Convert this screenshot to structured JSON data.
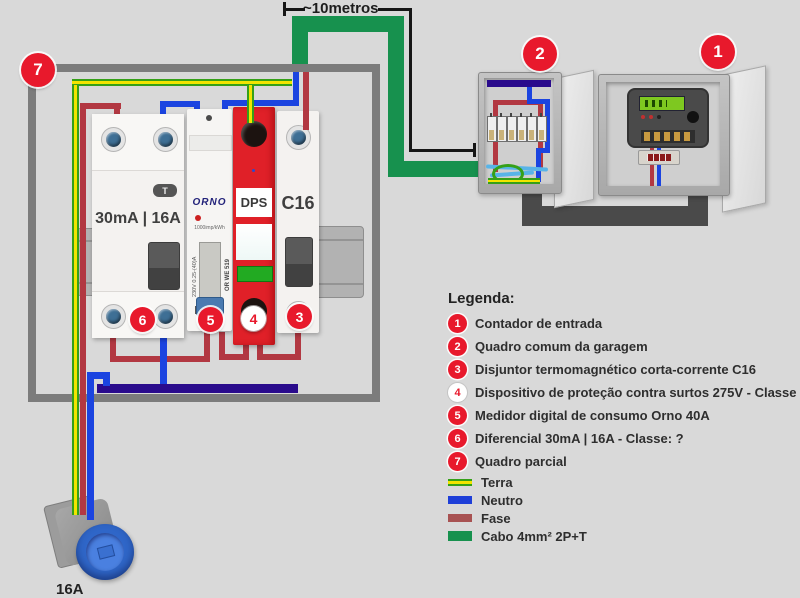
{
  "dimension_label": "~10metros",
  "panel": {
    "badge": "7",
    "rcd": {
      "label": "30mA | 16A",
      "test_button": "T",
      "badge": "6"
    },
    "meter": {
      "brand": "ORNO",
      "imp": "1000imp/kWh",
      "rating": "230V 0.25-(40)A",
      "model": "OR WE 519",
      "ce": "CE",
      "badge": "5"
    },
    "dps": {
      "label": "DPS",
      "badge": "4"
    },
    "breaker": {
      "label": "C16",
      "badge": "3"
    }
  },
  "garage_box": {
    "badge": "2"
  },
  "entry_box": {
    "badge": "1"
  },
  "socket": {
    "label": "16A"
  },
  "legend": {
    "title": "Legenda:",
    "items": [
      {
        "num": "1",
        "text": "Contador de entrada"
      },
      {
        "num": "2",
        "text": "Quadro comum da garagem"
      },
      {
        "num": "3",
        "text": "Disjuntor termomagnético corta-corrente C16"
      },
      {
        "num": "4",
        "text": "Dispositivo de proteção contra surtos 275V - Classe II"
      },
      {
        "num": "5",
        "text": "Medidor digital de consumo Orno 40A"
      },
      {
        "num": "6",
        "text": "Diferencial 30mA | 16A - Classe: ?"
      },
      {
        "num": "7",
        "text": "Quadro parcial"
      }
    ],
    "wire_keys": [
      {
        "label": "Terra"
      },
      {
        "label": "Neutro"
      },
      {
        "label": "Fase"
      },
      {
        "label": "Cabo 4mm² 2P+T"
      }
    ]
  },
  "colors": {
    "fase": "#b23842",
    "neutro": "#1b44e0",
    "terra_green": "#35a018",
    "terra_yellow": "#f2e400",
    "cable_green": "#17914e",
    "interlink_cable": "#4a4a4a",
    "badge_red": "#e8192c",
    "neutral_bus": "#2a0b8c"
  }
}
